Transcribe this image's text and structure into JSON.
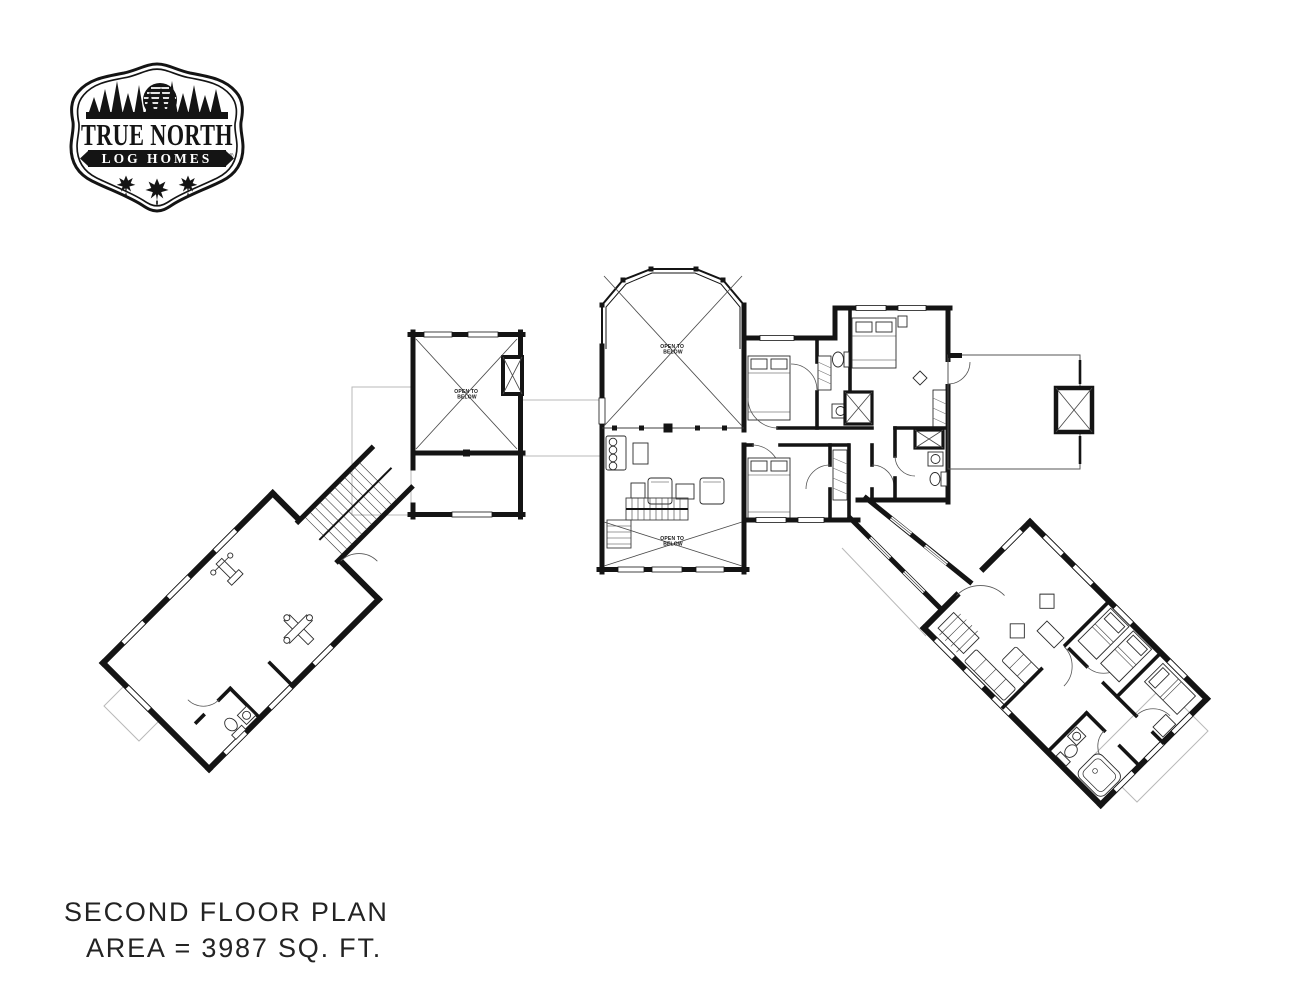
{
  "logo": {
    "title_line": "TRUE NORTH",
    "subtitle_line": "LOG HOMES",
    "trademark": "®"
  },
  "plan_labels": {
    "open_to_below_l1": "OPEN TO",
    "open_to_below_l2": "BELOW"
  },
  "caption": {
    "line1": "SECOND FLOOR PLAN",
    "line2": "AREA = 3987 SQ. FT."
  },
  "colors": {
    "wall": "#141414",
    "detail_line": "#3c3c3c",
    "roof_line": "#b9b9b9",
    "text": "#232323",
    "background": "#ffffff"
  }
}
